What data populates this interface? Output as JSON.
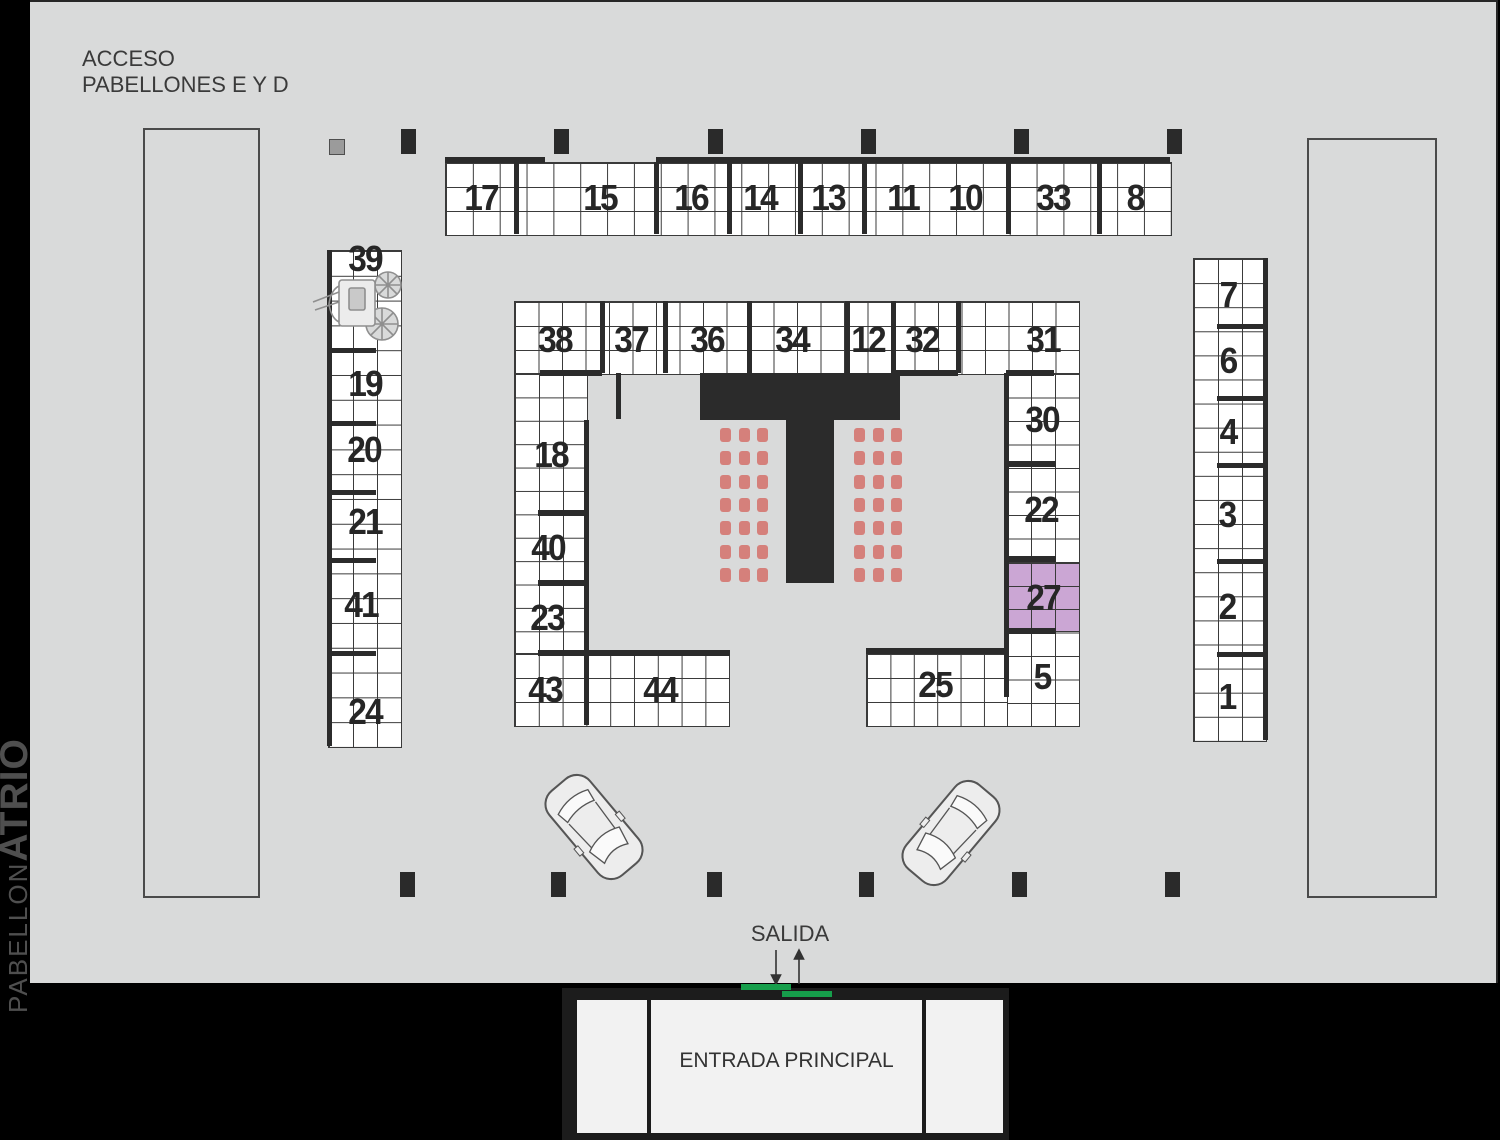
{
  "header": {
    "access_line1": "ACCESO",
    "access_line2": "PABELLONES E Y D"
  },
  "side": {
    "pabellon": "PABELLON",
    "atrio": "ATRIO"
  },
  "exit": {
    "label": "SALIDA"
  },
  "entrance": {
    "label": "ENTRADA PRINCIPAL"
  },
  "highlight": {
    "booth": "27",
    "color": "#cba6d4"
  },
  "colors": {
    "chair": "#d5807b",
    "exit_marker": "#169e4b",
    "wall": "#2b2b2b",
    "panel": "#d9dada"
  },
  "booths": [
    {
      "id": "17",
      "x": 481,
      "y": 198
    },
    {
      "id": "15",
      "x": 600,
      "y": 198
    },
    {
      "id": "16",
      "x": 691,
      "y": 198
    },
    {
      "id": "14",
      "x": 760,
      "y": 198
    },
    {
      "id": "13",
      "x": 828,
      "y": 198
    },
    {
      "id": "11",
      "x": 903,
      "y": 198
    },
    {
      "id": "10",
      "x": 965,
      "y": 198
    },
    {
      "id": "33",
      "x": 1053,
      "y": 198
    },
    {
      "id": "8",
      "x": 1135,
      "y": 198
    },
    {
      "id": "38",
      "x": 555,
      "y": 340
    },
    {
      "id": "37",
      "x": 631,
      "y": 340
    },
    {
      "id": "36",
      "x": 707,
      "y": 340
    },
    {
      "id": "34",
      "x": 792,
      "y": 340
    },
    {
      "id": "12",
      "x": 868,
      "y": 340
    },
    {
      "id": "32",
      "x": 922,
      "y": 340
    },
    {
      "id": "31",
      "x": 1043,
      "y": 340
    },
    {
      "id": "39",
      "x": 365,
      "y": 259
    },
    {
      "id": "19",
      "x": 365,
      "y": 384
    },
    {
      "id": "20",
      "x": 364,
      "y": 450
    },
    {
      "id": "21",
      "x": 365,
      "y": 522
    },
    {
      "id": "41",
      "x": 361,
      "y": 605
    },
    {
      "id": "24",
      "x": 365,
      "y": 712
    },
    {
      "id": "18",
      "x": 551,
      "y": 455
    },
    {
      "id": "40",
      "x": 548,
      "y": 548
    },
    {
      "id": "23",
      "x": 547,
      "y": 618
    },
    {
      "id": "43",
      "x": 545,
      "y": 690
    },
    {
      "id": "44",
      "x": 660,
      "y": 690
    },
    {
      "id": "30",
      "x": 1042,
      "y": 420
    },
    {
      "id": "22",
      "x": 1041,
      "y": 510
    },
    {
      "id": "27",
      "x": 1043,
      "y": 598
    },
    {
      "id": "5",
      "x": 1042,
      "y": 677
    },
    {
      "id": "25",
      "x": 935,
      "y": 685
    },
    {
      "id": "7",
      "x": 1228,
      "y": 295
    },
    {
      "id": "6",
      "x": 1228,
      "y": 361
    },
    {
      "id": "4",
      "x": 1228,
      "y": 432
    },
    {
      "id": "3",
      "x": 1227,
      "y": 515
    },
    {
      "id": "2",
      "x": 1227,
      "y": 607
    },
    {
      "id": "1",
      "x": 1227,
      "y": 697
    }
  ]
}
